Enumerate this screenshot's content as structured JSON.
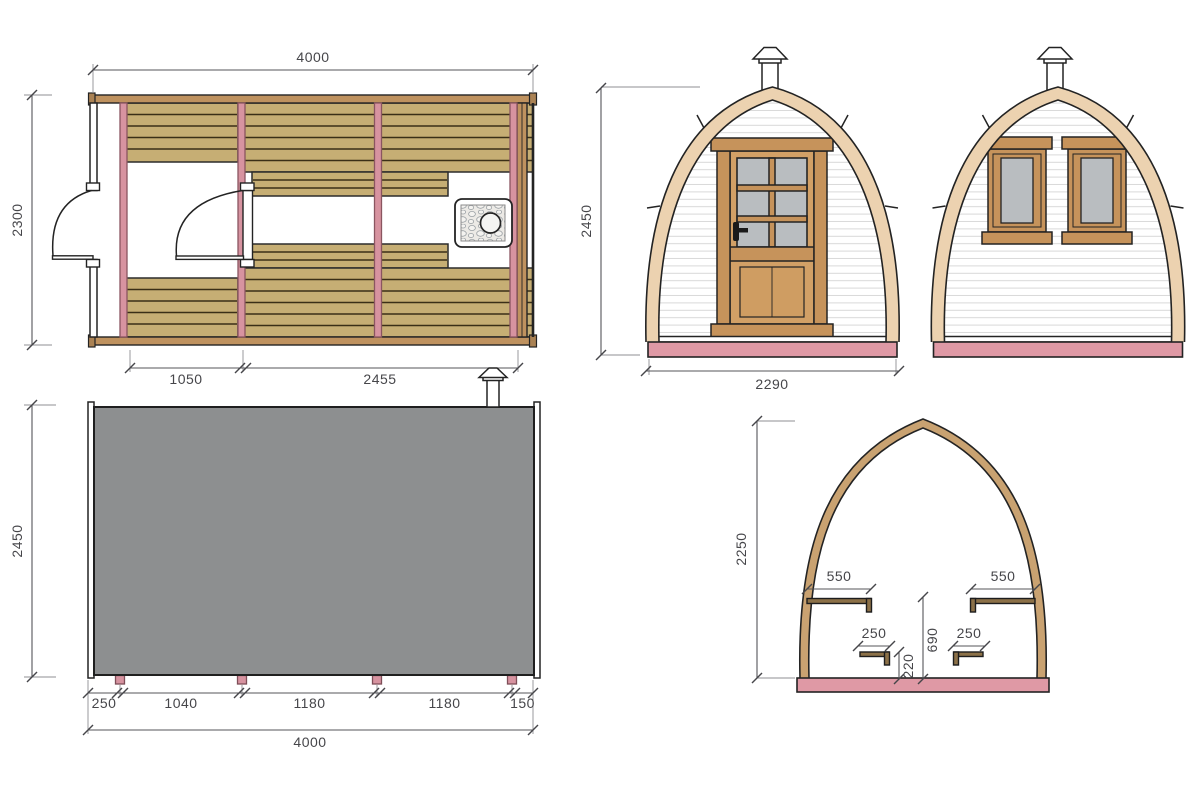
{
  "drawing": {
    "floor_plan": {
      "width_total": "4000",
      "depth_total": "2300",
      "bay_left": "1050",
      "bay_right": "2455"
    },
    "front_elevation": {
      "height_total": "2450",
      "width_total": "2290"
    },
    "side_elevation": {
      "height_total": "2450",
      "base_segments": [
        "250",
        "1040",
        "1180",
        "1180",
        "150"
      ],
      "length_total": "4000"
    },
    "cross_section": {
      "height_internal": "2250",
      "bench_top_left": "550",
      "bench_top_right": "550",
      "bench_step_left": "250",
      "bench_step_right": "250",
      "bench_height": "690",
      "step_height": "220"
    },
    "colors": {
      "accent_pink": "#df99a5",
      "rim_tan": "#ecd2b0",
      "section_rim": "#c9a271",
      "plank_tan": "#c6ae74",
      "wood_brown": "#c6935b",
      "panel_gray": "#8d8f90",
      "glass_gray": "#b9bdc0",
      "dimension_gray": "#46464a"
    }
  }
}
